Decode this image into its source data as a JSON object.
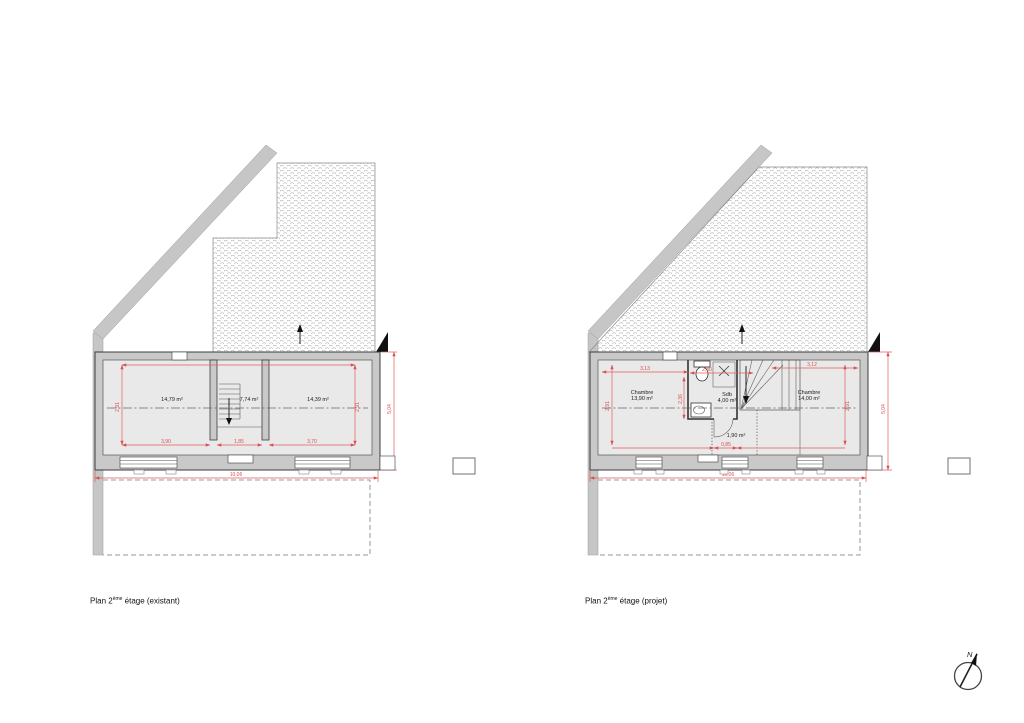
{
  "existing": {
    "caption": {
      "prefix": "Plan 2",
      "sup": "ème",
      "suffix": " étage (existant)"
    },
    "rooms": {
      "room1": "14,79 m²",
      "stair": "7,74 m²",
      "room2": "14,39 m²"
    },
    "dims": {
      "seg1": "3,90",
      "seg2": "1,85",
      "seg3": "3,70",
      "total": "10,06",
      "height": "5,04",
      "inner_left": "2,91",
      "inner_right": "2,91"
    }
  },
  "project": {
    "caption": {
      "prefix": "Plan 2",
      "sup": "ème",
      "suffix": " étage (projet)"
    },
    "rooms": {
      "chambre1_name": "Chambre",
      "chambre1_area": "13,90 m²",
      "sdb_name": "Sdb",
      "sdb_area": "4,00 m²",
      "hall_area": "1,90 m²",
      "chambre2_name": "Chambre",
      "chambre2_area": "14,00 m²"
    },
    "dims": {
      "top1": "3,13",
      "top2": "2,30",
      "top3": "3,12",
      "bath": "2,36",
      "inner_left": "2,91",
      "inner_right": "2,91",
      "hall": "0,85",
      "total": "10,06",
      "height": "5,04"
    }
  },
  "compass": {
    "label": "N"
  }
}
